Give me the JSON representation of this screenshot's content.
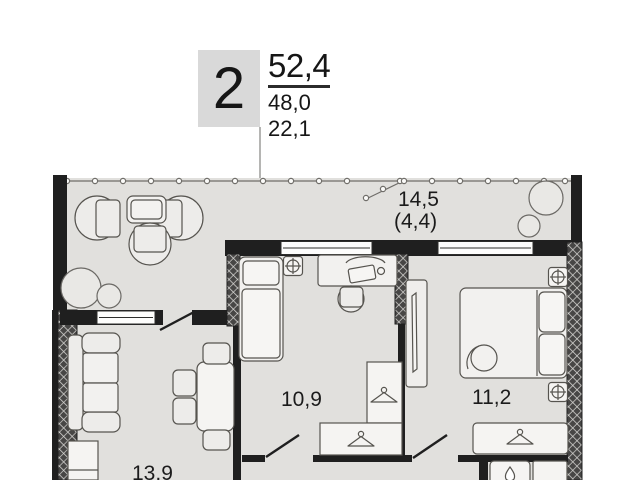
{
  "badge": {
    "value": "2"
  },
  "areas": {
    "line1": "52,4",
    "line2": "48,0",
    "line3": "22,1"
  },
  "rooms": {
    "balcony": {
      "area": "14,5",
      "area_secondary": "(4,4)"
    },
    "bedroom1": {
      "area": "10,9"
    },
    "bedroom2": {
      "area": "11,2"
    },
    "living": {
      "area": "13,9"
    }
  },
  "colors": {
    "floor": "#e1e0dd",
    "wall": "#1f1f1f",
    "badge_bg": "#d9d9d9",
    "furniture": "#edecea"
  },
  "icons": {
    "radiator": "radiator-icon",
    "hanger": "hanger-icon",
    "water_drop": "drop-icon",
    "plant": "plant-icon"
  }
}
